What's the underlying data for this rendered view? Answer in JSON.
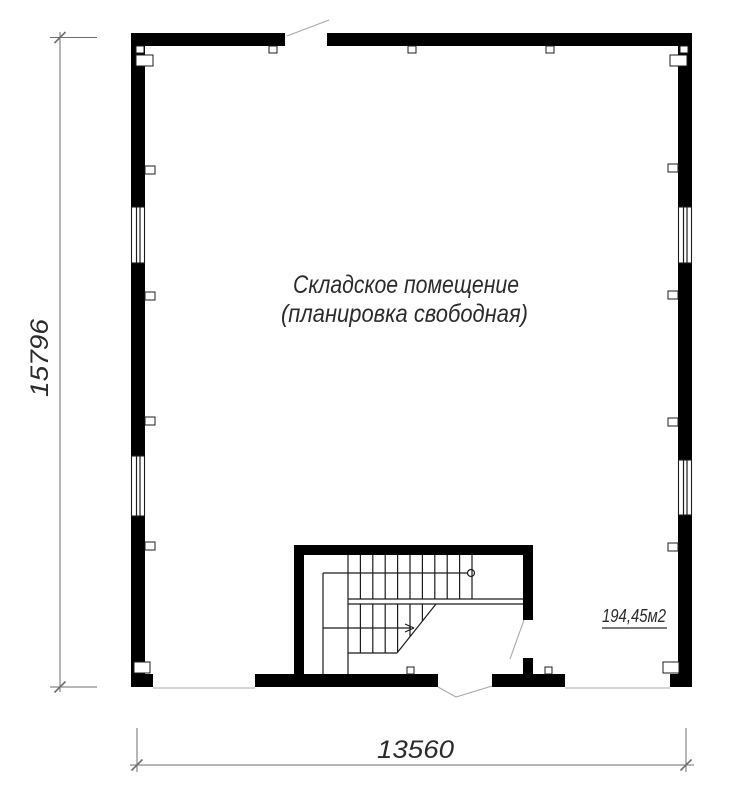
{
  "drawing": {
    "room_label_line1": "Складское помещение",
    "room_label_line2": "(планировка свободная)",
    "area_label": "194,45м2",
    "height_dimension": "15796",
    "width_dimension": "13560"
  },
  "colors": {
    "background": "#ffffff",
    "wall": "#000000",
    "thin_line": "#1c1c1c",
    "door_swing": "#a8a8a8",
    "dimension": "#6e6e6e",
    "text": "#2b2b2b"
  }
}
